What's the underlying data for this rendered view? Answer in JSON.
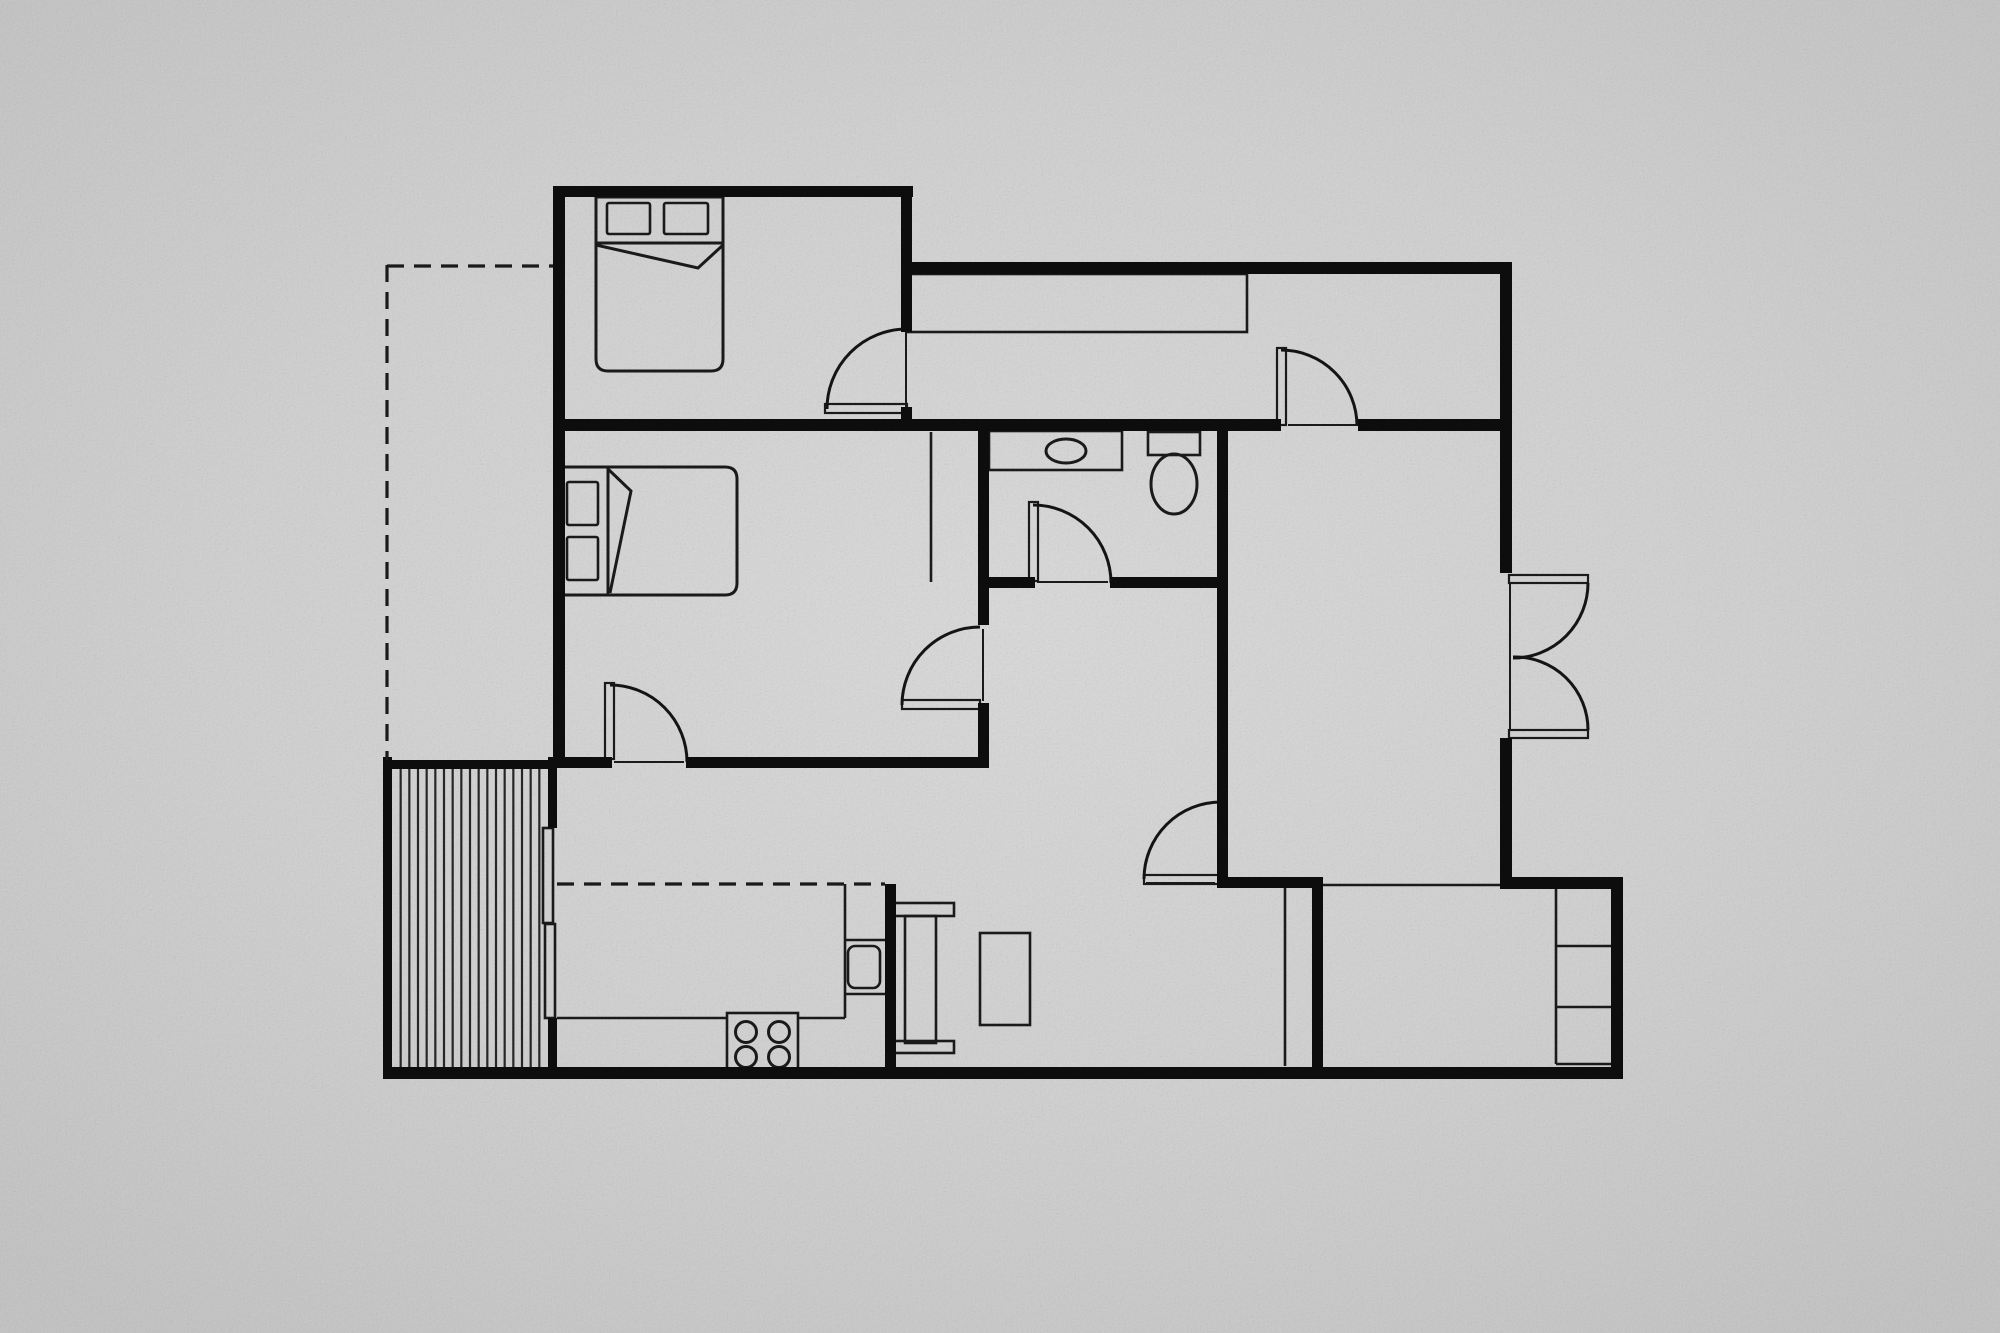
{
  "meta": {
    "title": "Black and white apartment floor plan on gray concrete background",
    "width": 2000,
    "height": 1333
  },
  "palette": {
    "background_center": "#d9d9d9",
    "background_edge": "#c2c2c2",
    "wall_color": "#0d0d0d",
    "line_color": "#1a1a1a"
  },
  "plan": {
    "walls": [
      {
        "name": "bedroom1-wall-north",
        "rect": [
          553,
          186,
          360,
          11
        ]
      },
      {
        "name": "west-wall",
        "rect": [
          553,
          186,
          12,
          582
        ]
      },
      {
        "name": "bedroom1-wall-east-upper",
        "rect": [
          901,
          186,
          11,
          146
        ]
      },
      {
        "name": "bedroom1-wall-east-stub",
        "rect": [
          901,
          407,
          11,
          14
        ]
      },
      {
        "name": "center-wall-band-west",
        "rect": [
          553,
          419,
          728,
          12
        ]
      },
      {
        "name": "center-wall-band-east",
        "rect": [
          1358,
          419,
          154,
          12
        ]
      },
      {
        "name": "north-wing-wall-top",
        "rect": [
          905,
          262,
          607,
          12
        ]
      },
      {
        "name": "east-wall-upper",
        "rect": [
          1500,
          262,
          12,
          311
        ]
      },
      {
        "name": "east-wall-mid",
        "rect": [
          1500,
          738,
          12,
          146
        ]
      },
      {
        "name": "bedroom2-wall-east-upper",
        "rect": [
          978,
          431,
          11,
          194
        ]
      },
      {
        "name": "bedroom2-wall-east-lower",
        "rect": [
          978,
          703,
          11,
          65
        ]
      },
      {
        "name": "livingroom-wall-east",
        "rect": [
          1217,
          431,
          11,
          453
        ]
      },
      {
        "name": "bathroom-wall-south-west",
        "rect": [
          989,
          577,
          46,
          11
        ]
      },
      {
        "name": "bathroom-wall-south-east",
        "rect": [
          1110,
          577,
          107,
          11
        ]
      },
      {
        "name": "bedroom2-wall-south-west",
        "rect": [
          553,
          757,
          59,
          11
        ]
      },
      {
        "name": "bedroom2-wall-south-east",
        "rect": [
          686,
          757,
          303,
          11
        ]
      },
      {
        "name": "deck-wall-west",
        "rect": [
          383,
          757,
          9,
          322
        ]
      },
      {
        "name": "deck-wall-north",
        "rect": [
          383,
          760,
          172,
          9
        ]
      },
      {
        "name": "kitchen-wall-west-upper",
        "rect": [
          548,
          757,
          9,
          71
        ]
      },
      {
        "name": "kitchen-wall-west-lower",
        "rect": [
          548,
          1018,
          9,
          61
        ]
      },
      {
        "name": "south-wall",
        "rect": [
          383,
          1067,
          1240,
          12
        ]
      },
      {
        "name": "kitchen-wall-east",
        "rect": [
          885,
          884,
          11,
          183
        ]
      },
      {
        "name": "hall-door-wall",
        "rect": [
          1217,
          877,
          106,
          11
        ]
      },
      {
        "name": "storage-wall-east",
        "rect": [
          1312,
          884,
          11,
          183
        ]
      },
      {
        "name": "se-room-wall-north",
        "rect": [
          1500,
          877,
          123,
          12
        ]
      },
      {
        "name": "east-wall-lower",
        "rect": [
          1611,
          877,
          12,
          202
        ]
      }
    ],
    "thin_rects": [
      {
        "name": "hallway-closet",
        "rect": [
          908,
          274,
          339,
          58
        ],
        "rx": 0
      },
      {
        "name": "bed1-pillow-left",
        "rect": [
          607,
          203,
          43,
          31
        ],
        "rx": 2
      },
      {
        "name": "bed1-pillow-right",
        "rect": [
          664,
          203,
          44,
          31
        ],
        "rx": 2
      },
      {
        "name": "bed2-pillow-top",
        "rect": [
          567,
          482,
          31,
          43
        ],
        "rx": 2
      },
      {
        "name": "bed2-pillow-bottom",
        "rect": [
          567,
          537,
          31,
          43
        ],
        "rx": 2
      },
      {
        "name": "bathroom-sink-counter",
        "rect": [
          989,
          431,
          133,
          39
        ],
        "rx": 0
      },
      {
        "name": "toilet-tank",
        "rect": [
          1148,
          432,
          52,
          23
        ],
        "rx": 0
      },
      {
        "name": "stove",
        "rect": [
          727,
          1013,
          71,
          60
        ],
        "rx": 0
      },
      {
        "name": "kitchen-sink",
        "rect": [
          848,
          946,
          32,
          42
        ],
        "rx": 7
      },
      {
        "name": "dining-bench-north",
        "rect": [
          894,
          903,
          60,
          13
        ],
        "rx": 0
      },
      {
        "name": "dining-table",
        "rect": [
          905,
          916,
          31,
          127
        ],
        "rx": 0
      },
      {
        "name": "dining-bench-south",
        "rect": [
          894,
          1041,
          60,
          12
        ],
        "rx": 0
      },
      {
        "name": "coffee-table",
        "rect": [
          980,
          933,
          50,
          92
        ],
        "rx": 0
      },
      {
        "name": "slider-panel-upper",
        "rect": [
          543,
          828,
          10,
          95
        ],
        "rx": 0
      },
      {
        "name": "slider-panel-lower",
        "rect": [
          545,
          924,
          10,
          94
        ],
        "rx": 0
      }
    ],
    "thin_lines": [
      {
        "name": "bedroom2-closet-line",
        "from": [
          931,
          432
        ],
        "to": [
          931,
          582
        ]
      },
      {
        "name": "se-room-top-line",
        "from": [
          1323,
          885
        ],
        "to": [
          1500,
          885
        ]
      },
      {
        "name": "storage-closet-divider",
        "from": [
          1285,
          888
        ],
        "to": [
          1285,
          1066
        ]
      },
      {
        "name": "shelf-column-edge",
        "from": [
          1556,
          888
        ],
        "to": [
          1556,
          1064
        ]
      },
      {
        "name": "shelf-divider-1",
        "from": [
          1556,
          946
        ],
        "to": [
          1611,
          946
        ]
      },
      {
        "name": "shelf-divider-2",
        "from": [
          1556,
          1007
        ],
        "to": [
          1611,
          1007
        ]
      },
      {
        "name": "shelf-base",
        "from": [
          1556,
          1064
        ],
        "to": [
          1611,
          1064
        ]
      },
      {
        "name": "counter-column-edge",
        "from": [
          845,
          884
        ],
        "to": [
          845,
          1018
        ]
      },
      {
        "name": "counter-divider-1",
        "from": [
          845,
          940
        ],
        "to": [
          885,
          940
        ]
      },
      {
        "name": "counter-divider-2",
        "from": [
          845,
          994
        ],
        "to": [
          885,
          994
        ]
      },
      {
        "name": "counter-front-west",
        "from": [
          557,
          1018
        ],
        "to": [
          727,
          1018
        ]
      },
      {
        "name": "counter-front-east",
        "from": [
          798,
          1018
        ],
        "to": [
          845,
          1018
        ]
      }
    ],
    "thresholds": [
      {
        "name": "threshold-bedroom1-door",
        "from": [
          906,
          331
        ],
        "to": [
          906,
          407
        ]
      },
      {
        "name": "threshold-bedroom2-south-door",
        "from": [
          614,
          762
        ],
        "to": [
          684,
          762
        ]
      },
      {
        "name": "threshold-bedroom2-east-door",
        "from": [
          983,
          629
        ],
        "to": [
          983,
          701
        ]
      },
      {
        "name": "threshold-hallway-door",
        "from": [
          1288,
          425
        ],
        "to": [
          1356,
          425
        ]
      },
      {
        "name": "threshold-bathroom-door",
        "from": [
          1037,
          582
        ],
        "to": [
          1108,
          582
        ]
      },
      {
        "name": "threshold-living-door",
        "from": [
          1146,
          883
        ],
        "to": [
          1215,
          883
        ]
      },
      {
        "name": "threshold-french-doors",
        "from": [
          1510,
          583
        ],
        "to": [
          1510,
          730
        ]
      }
    ],
    "furniture_paths": [
      {
        "name": "bed1-body",
        "d": "M 596 197 L 723 197 L 723 359 Q 723 371 711 371 L 608 371 Q 596 371 596 359 Z"
      },
      {
        "name": "bed1-fold",
        "d": "M 596 243 L 723 243 M 596 245 L 698 268 L 723 245"
      },
      {
        "name": "bed2-body",
        "d": "M 560 467 L 725 467 Q 737 467 737 479 L 737 583 Q 737 595 725 595 L 560 595 Z"
      },
      {
        "name": "bed2-fold",
        "d": "M 608 467 L 608 595 M 608 469 L 631 491 L 610 593"
      }
    ],
    "ellipses": [
      {
        "name": "sink-basin",
        "cx": 1066,
        "cy": 451,
        "rx": 20,
        "ry": 12
      },
      {
        "name": "toilet-bowl",
        "cx": 1174,
        "cy": 484,
        "rx": 23,
        "ry": 30
      }
    ],
    "circles": [
      {
        "name": "burner-1",
        "cx": 746,
        "cy": 1032,
        "r": 10.5
      },
      {
        "name": "burner-2",
        "cx": 779,
        "cy": 1032,
        "r": 10.5
      },
      {
        "name": "burner-3",
        "cx": 746,
        "cy": 1057,
        "r": 10.5
      },
      {
        "name": "burner-4",
        "cx": 779,
        "cy": 1057,
        "r": 10.5
      }
    ],
    "door_leaves": [
      {
        "name": "door-leaf-bedroom1",
        "rect": [
          825,
          404,
          82,
          9
        ]
      },
      {
        "name": "door-leaf-bedroom2-south",
        "rect": [
          605,
          683,
          9,
          76
        ]
      },
      {
        "name": "door-leaf-bedroom2-east",
        "rect": [
          902,
          700,
          78,
          9
        ]
      },
      {
        "name": "door-leaf-hallway",
        "rect": [
          1277,
          348,
          9,
          77
        ]
      },
      {
        "name": "door-leaf-bathroom",
        "rect": [
          1029,
          502,
          9,
          79
        ]
      },
      {
        "name": "door-leaf-living",
        "rect": [
          1144,
          875,
          78,
          9
        ]
      },
      {
        "name": "door-leaf-french-top",
        "rect": [
          1509,
          575,
          79,
          8
        ]
      },
      {
        "name": "door-leaf-french-bottom",
        "rect": [
          1509,
          730,
          79,
          8
        ]
      }
    ],
    "door_arcs": [
      {
        "name": "door-arc-bedroom1",
        "d": "M 827 409 A 80 80 0 0 1 907 329"
      },
      {
        "name": "door-arc-bedroom2-south",
        "d": "M 610 685 A 77 77 0 0 1 687 762"
      },
      {
        "name": "door-arc-bedroom2-east",
        "d": "M 902 705 A 78 78 0 0 1 980 627"
      },
      {
        "name": "door-arc-hallway",
        "d": "M 1281 350 A 76 76 0 0 1 1357 426"
      },
      {
        "name": "door-arc-bathroom",
        "d": "M 1033 505 A 78 78 0 0 1 1111 583"
      },
      {
        "name": "door-arc-living",
        "d": "M 1144 879 A 77 77 0 0 1 1221 802"
      },
      {
        "name": "door-arc-french-top",
        "d": "M 1588 583 A 75 75 0 0 1 1513 658"
      },
      {
        "name": "door-arc-french-bottom",
        "d": "M 1588 730 A 73 73 0 0 0 1513 657"
      }
    ],
    "dashed_lines": [
      {
        "name": "extension-outline-west",
        "from": [
          387,
          265
        ],
        "to": [
          387,
          760
        ]
      },
      {
        "name": "extension-outline-north",
        "from": [
          387,
          266
        ],
        "to": [
          553,
          266
        ]
      },
      {
        "name": "kitchen-upper-cabinets",
        "from": [
          557,
          884
        ],
        "to": [
          885,
          884
        ]
      }
    ],
    "deck_stripes": {
      "name": "deck-board",
      "x_start": 392,
      "x_end": 548,
      "y_top": 769,
      "y_bottom": 1067,
      "count": 17
    }
  }
}
